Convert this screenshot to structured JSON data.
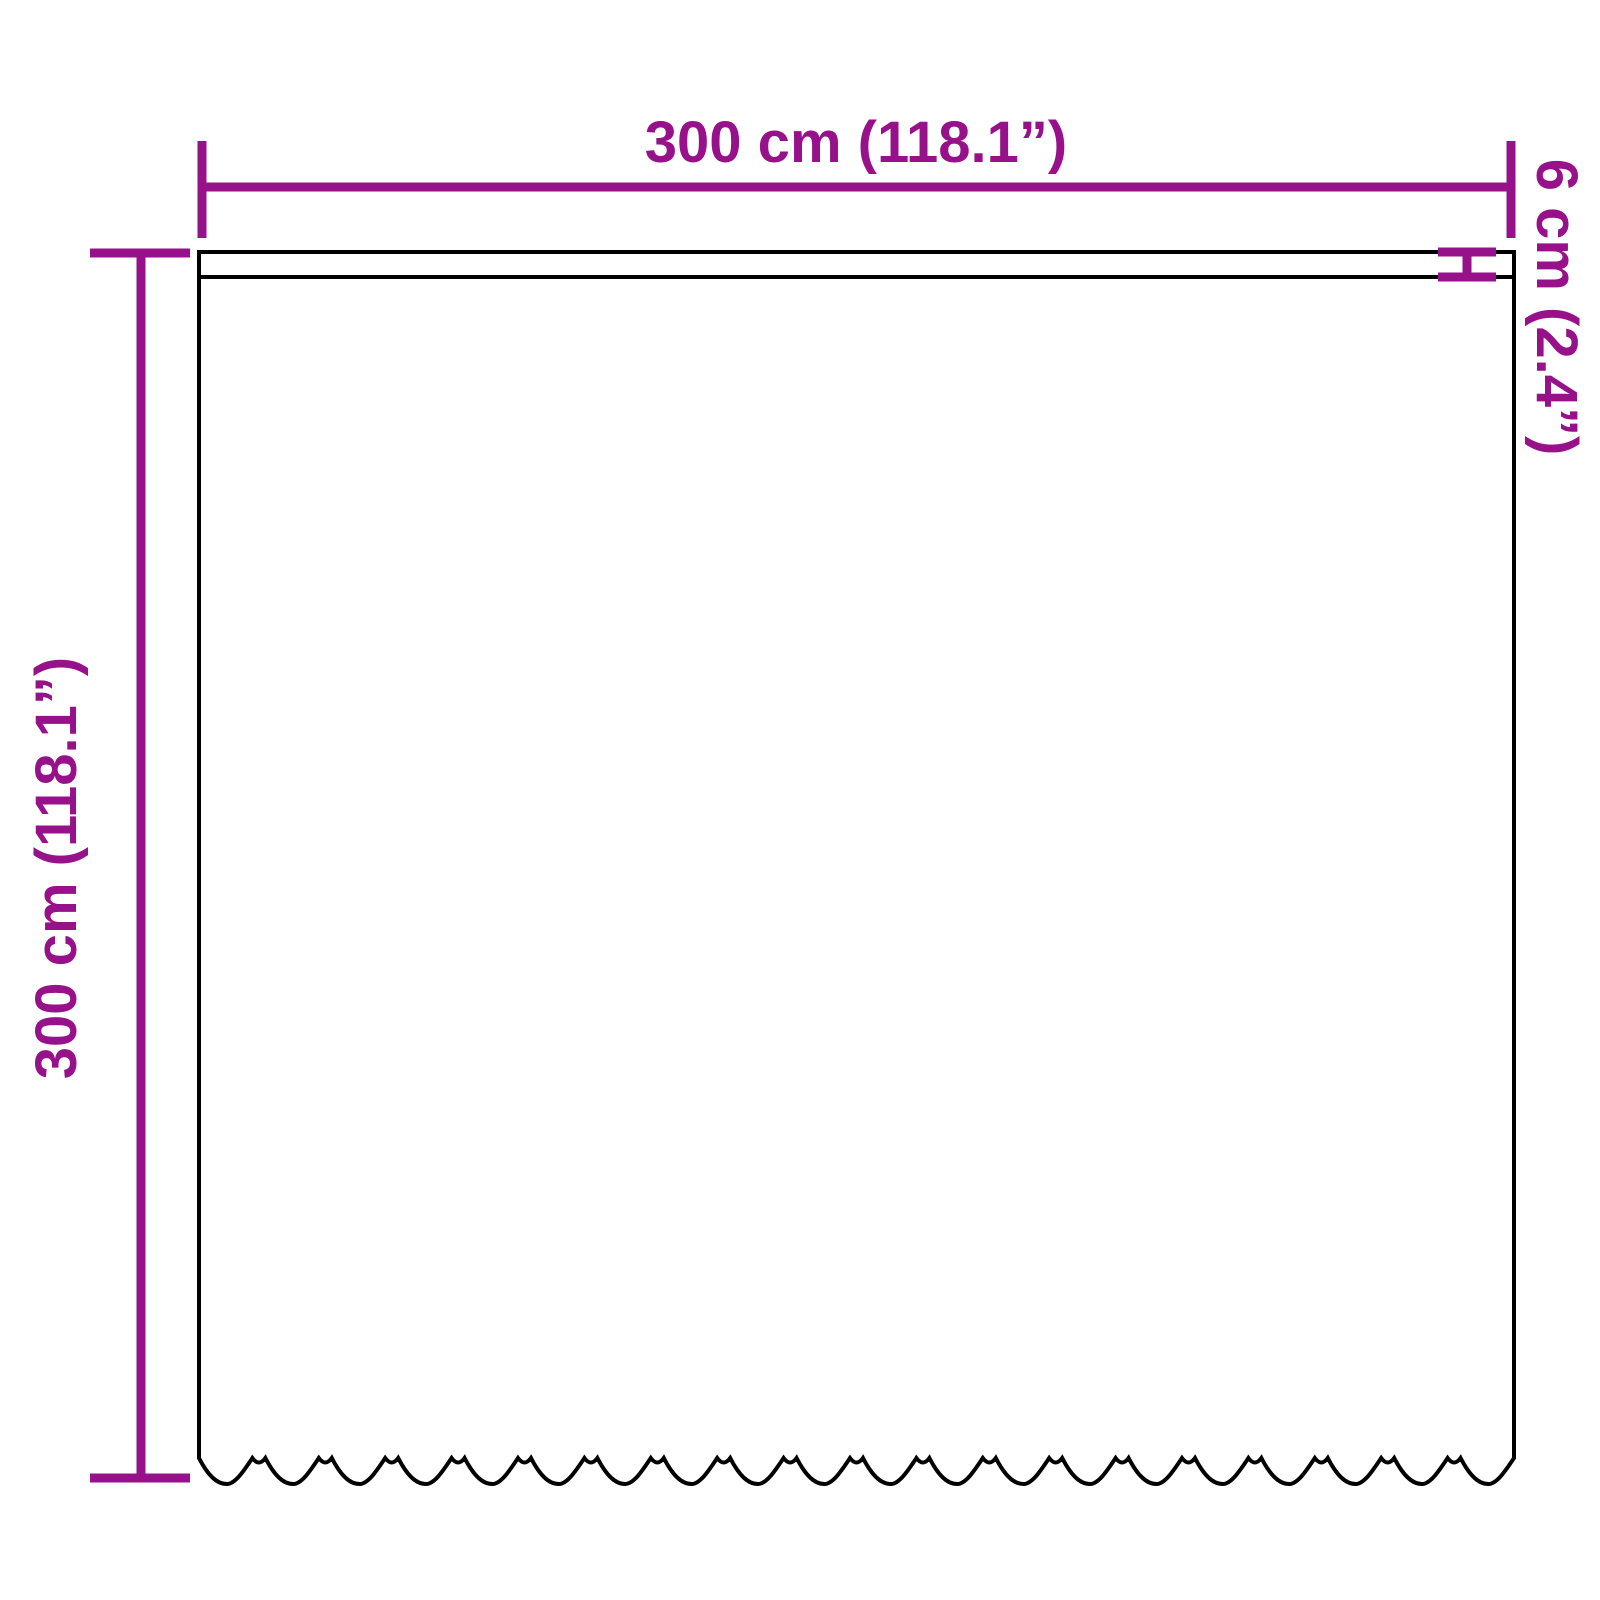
{
  "diagram": {
    "labels": {
      "width": "300 cm (118.1”)",
      "height": "300 cm (118.1”)",
      "header_height": "6 cm (2.4”)"
    },
    "colors": {
      "dimension_accent": "#97118A",
      "outline": "#000000",
      "background": "#FFFFFF"
    }
  }
}
